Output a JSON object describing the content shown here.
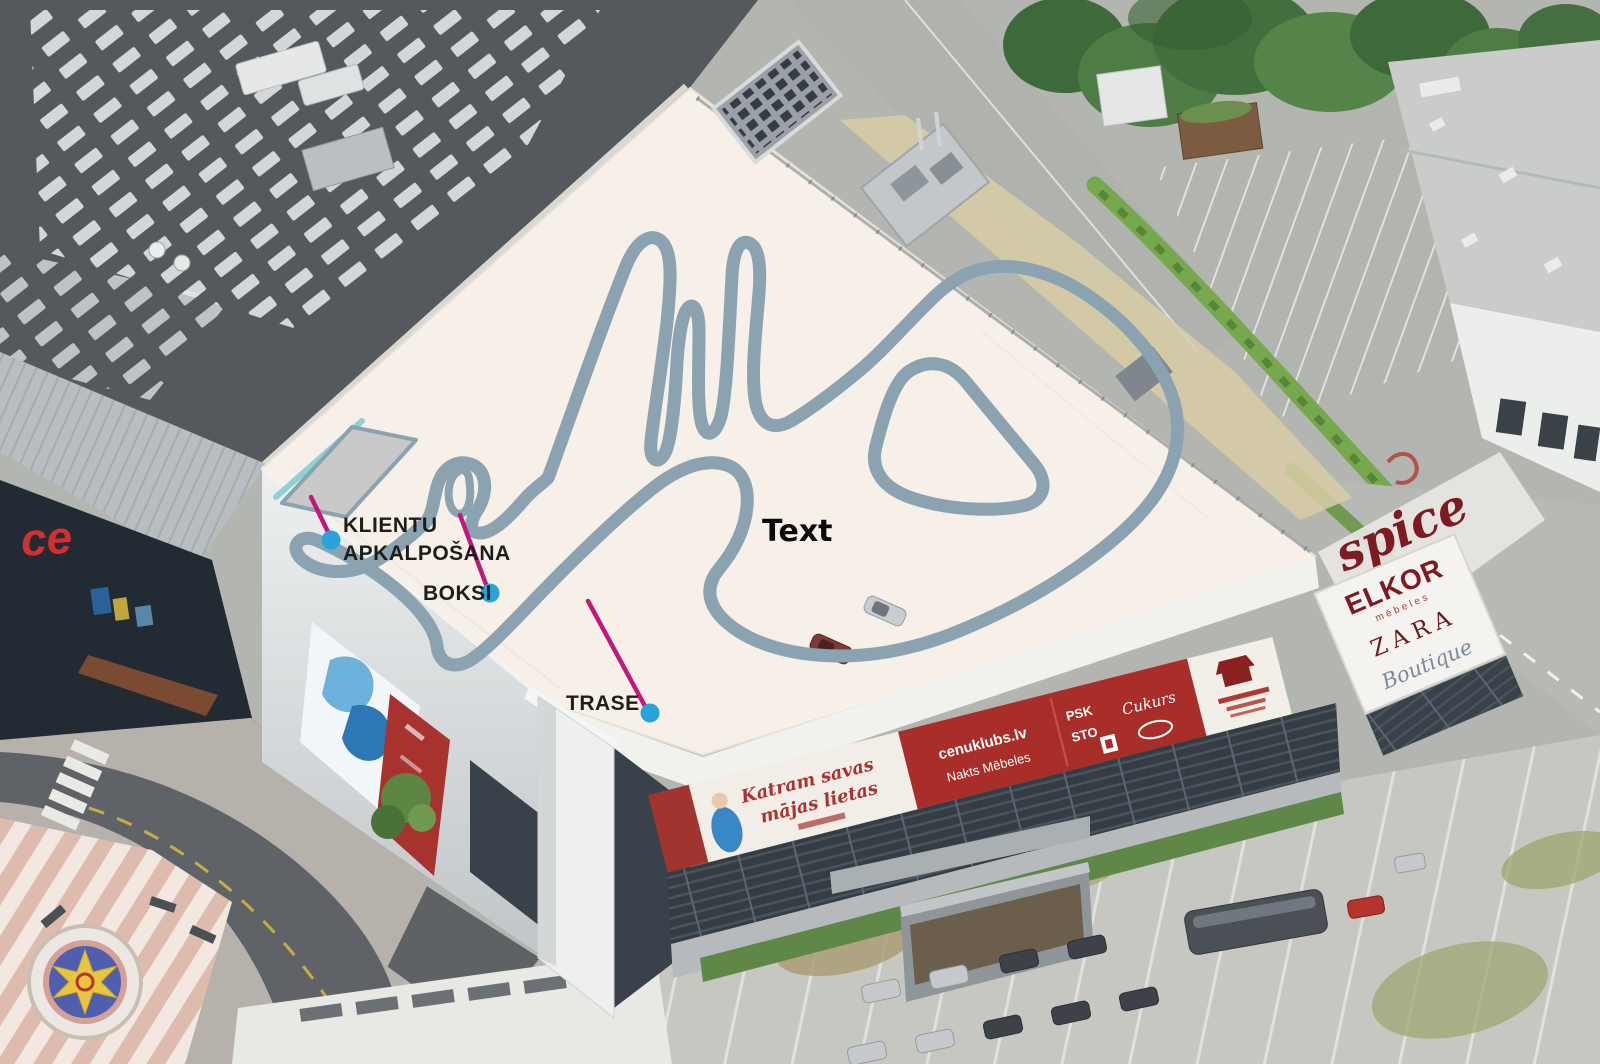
{
  "scene": {
    "description": "Aerial photo of the Spice shopping centre with a rooftop go-kart track drawing",
    "center_label": "Text"
  },
  "annotations": {
    "klientu": {
      "line1": "KLIENTU",
      "line2": "APKALPOŠANA"
    },
    "boksi": {
      "label": "BOKSI"
    },
    "trase": {
      "label": "TRASE"
    }
  },
  "signage": {
    "spice_logo": "spice",
    "glass_letters": "ce",
    "panel_brand": "ELKOR",
    "panel_sub": "mēbeles",
    "panel_line2": "ZARA",
    "panel_line3": "Boutique",
    "banner_white_1": "Katram savas",
    "banner_white_2": "mājas lietas",
    "banner_red_site": "cenuklubs.lv",
    "banner_red_sub": "Nakts Mēbeles",
    "banner_small_1": "PSK",
    "banner_small_2": "STO",
    "banner_small_3": "Cukurs"
  },
  "colors": {
    "track": "#8ba3b0",
    "leader_line": "#c2187e",
    "marker_dot": "#29a3db",
    "roof": "#f7f0e9",
    "service_area_fill": "#c9c9c9",
    "label_text": "#1d1d1b"
  }
}
